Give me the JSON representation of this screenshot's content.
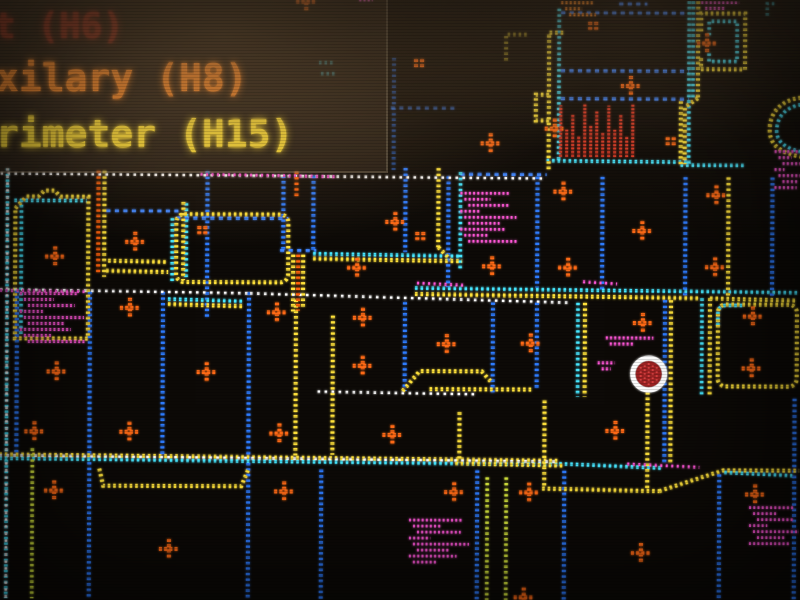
{
  "legend": {
    "items": [
      {
        "id": "zone-h6",
        "label": "t (H6)",
        "color": "#9c2f1e"
      },
      {
        "id": "zone-h8",
        "label": "xilary (H8)",
        "color": "#ff8a28"
      },
      {
        "id": "zone-h15",
        "label": "rimeter (H15)",
        "color": "#ffdf35"
      }
    ]
  },
  "map": {
    "colors": {
      "wall_yellow": "#ffe23a",
      "wall_cyan": "#46e7ff",
      "wall_blue": "#2e7bff",
      "corridor_white": "#ffffff",
      "device_orange": "#ff6a14",
      "text_magenta": "#ff57d8",
      "alert_red": "#d03028"
    },
    "alarm_marker": {
      "x": 649,
      "y": 373,
      "fill": "#9c2424",
      "ring": "#ffffff"
    },
    "device_markers": [
      [
        706,
        42
      ],
      [
        630,
        85
      ],
      [
        554,
        128
      ],
      [
        490,
        143
      ],
      [
        563,
        191
      ],
      [
        716,
        194
      ],
      [
        642,
        230
      ],
      [
        55,
        258
      ],
      [
        135,
        243
      ],
      [
        395,
        222
      ],
      [
        492,
        266
      ],
      [
        568,
        267
      ],
      [
        715,
        266
      ],
      [
        357,
        268
      ],
      [
        277,
        313
      ],
      [
        363,
        318
      ],
      [
        130,
        309
      ],
      [
        363,
        366
      ],
      [
        447,
        344
      ],
      [
        531,
        343
      ],
      [
        57,
        373
      ],
      [
        207,
        373
      ],
      [
        643,
        322
      ],
      [
        753,
        315
      ],
      [
        752,
        367
      ],
      [
        35,
        433
      ],
      [
        130,
        433
      ],
      [
        280,
        434
      ],
      [
        393,
        435
      ],
      [
        616,
        430
      ],
      [
        55,
        492
      ],
      [
        285,
        492
      ],
      [
        455,
        492
      ],
      [
        530,
        492
      ],
      [
        756,
        493
      ],
      [
        170,
        550
      ],
      [
        642,
        552
      ],
      [
        525,
        597
      ],
      [
        305,
        2
      ]
    ],
    "tick_marks": [
      [
        592,
        25
      ],
      [
        418,
        63
      ],
      [
        670,
        140
      ],
      [
        420,
        236
      ],
      [
        202,
        231
      ]
    ],
    "pixel_text_blocks": [
      {
        "x": 20,
        "y": 295,
        "w": 60,
        "h": 52,
        "color": "#ff57d8",
        "style": "rows"
      },
      {
        "x": 460,
        "y": 193,
        "w": 52,
        "h": 48,
        "color": "#ff57d8",
        "style": "rows"
      },
      {
        "x": 606,
        "y": 337,
        "w": 50,
        "h": 10,
        "color": "#ff57d8",
        "style": "rows"
      },
      {
        "x": 598,
        "y": 362,
        "w": 18,
        "h": 10,
        "color": "#ff57d8",
        "style": "rows"
      },
      {
        "x": 410,
        "y": 520,
        "w": 56,
        "h": 44,
        "color": "#ff57d8",
        "style": "rows"
      },
      {
        "x": 750,
        "y": 506,
        "w": 48,
        "h": 36,
        "color": "#ff57d8",
        "style": "rows"
      },
      {
        "x": 774,
        "y": 150,
        "w": 26,
        "h": 38,
        "color": "#ff57d8",
        "style": "rows"
      },
      {
        "x": 560,
        "y": 102,
        "w": 72,
        "h": 54,
        "color": "#e23a28",
        "style": "bars"
      },
      {
        "x": 560,
        "y": 2,
        "w": 34,
        "h": 12,
        "color": "#ff8a28",
        "style": "rows"
      },
      {
        "x": 700,
        "y": 1,
        "w": 40,
        "h": 6,
        "color": "#ff57d8",
        "style": "rows"
      },
      {
        "x": 358,
        "y": 0,
        "w": 14,
        "h": 4,
        "color": "#ff57d8",
        "style": "rows"
      }
    ]
  }
}
